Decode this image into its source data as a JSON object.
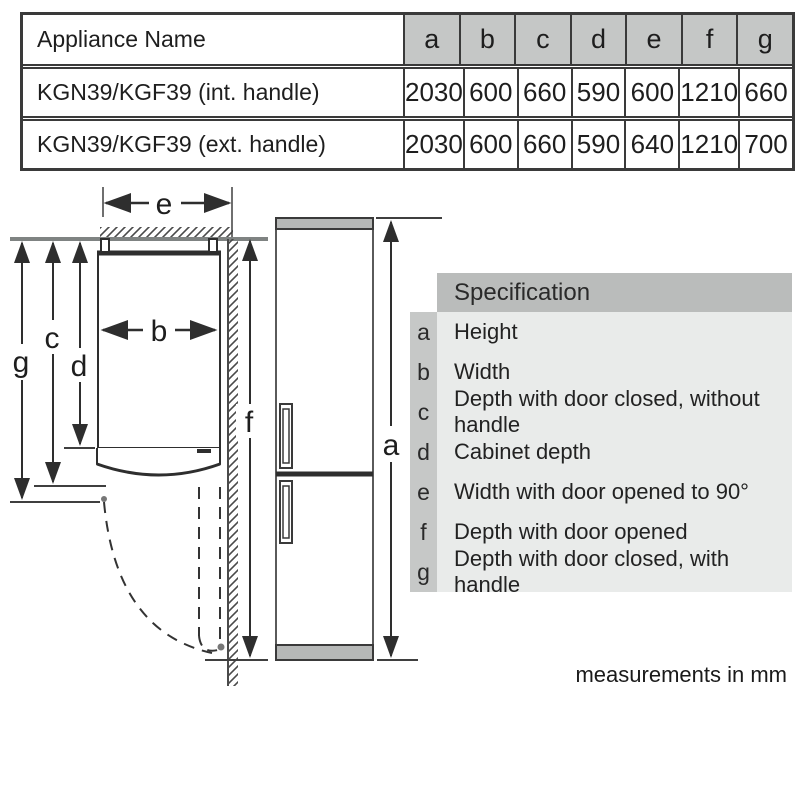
{
  "dim_table": {
    "name_header": "Appliance Name",
    "column_headers": [
      "a",
      "b",
      "c",
      "d",
      "e",
      "f",
      "g"
    ],
    "rows": [
      {
        "name": "KGN39/KGF39 (int. handle)",
        "values": [
          "2030",
          "600",
          "660",
          "590",
          "600",
          "1210",
          "660"
        ]
      },
      {
        "name": "KGN39/KGF39 (ext. handle)",
        "values": [
          "2030",
          "600",
          "660",
          "590",
          "640",
          "1210",
          "700"
        ]
      }
    ]
  },
  "legend": {
    "header": "Specification",
    "rows": [
      {
        "key": "a",
        "label": "Height"
      },
      {
        "key": "b",
        "label": "Width"
      },
      {
        "key": "c",
        "label": "Depth with door closed, without handle"
      },
      {
        "key": "d",
        "label": "Cabinet depth"
      },
      {
        "key": "e",
        "label": "Width with door opened to 90°"
      },
      {
        "key": "f",
        "label": "Depth with door opened"
      },
      {
        "key": "g",
        "label": "Depth with door closed, with handle"
      }
    ]
  },
  "diagram": {
    "labels": {
      "a": "a",
      "b": "b",
      "c": "c",
      "d": "d",
      "e": "e",
      "f": "f",
      "g": "g"
    }
  },
  "footnote": "measurements in mm",
  "colors": {
    "table_header_bg": "#c5c7c6",
    "legend_header_bg": "#babcbb",
    "legend_key_bg": "#c6c8c7",
    "legend_body_bg": "#e9ebea",
    "band_gray": "#b6b8b7",
    "line_dark": "#2e2e2e",
    "wall_gray": "#7f8382"
  }
}
